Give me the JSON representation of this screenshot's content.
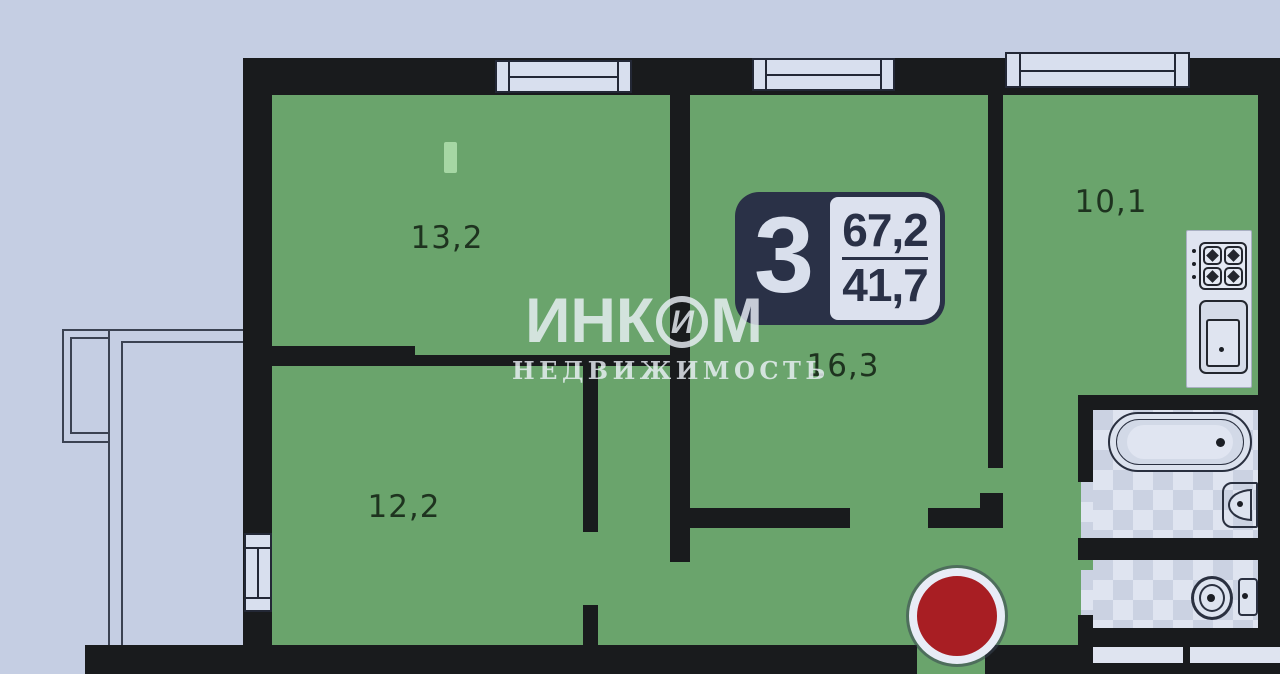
{
  "plan": {
    "badge": {
      "rooms_count": "3",
      "total_area": "67,2",
      "living_area": "41,7"
    },
    "rooms": [
      {
        "id": "room-13-2",
        "area_label": "13,2"
      },
      {
        "id": "room-12-2",
        "area_label": "12,2"
      },
      {
        "id": "room-16-3",
        "area_label": "16,3"
      },
      {
        "id": "kitchen-10-1",
        "area_label": "10,1"
      }
    ],
    "watermark": {
      "brand": "ИНК",
      "brand_symbol": "И",
      "brand_suffix": "М",
      "subtitle": "НЕДВИЖИМОСТЬ"
    },
    "colors": {
      "background": "#c5cee3",
      "wall": "#191b1d",
      "room_fill": "#6aa46c",
      "highlight_green": "#a6d7a4",
      "badge_navy": "#2a3147",
      "badge_panel": "#dce1ee",
      "marker_red": "#a81e23",
      "tile_light": "#dfe4f0",
      "tile_dark": "#cbd2e2",
      "fixture_white": "#dde3ef"
    }
  }
}
